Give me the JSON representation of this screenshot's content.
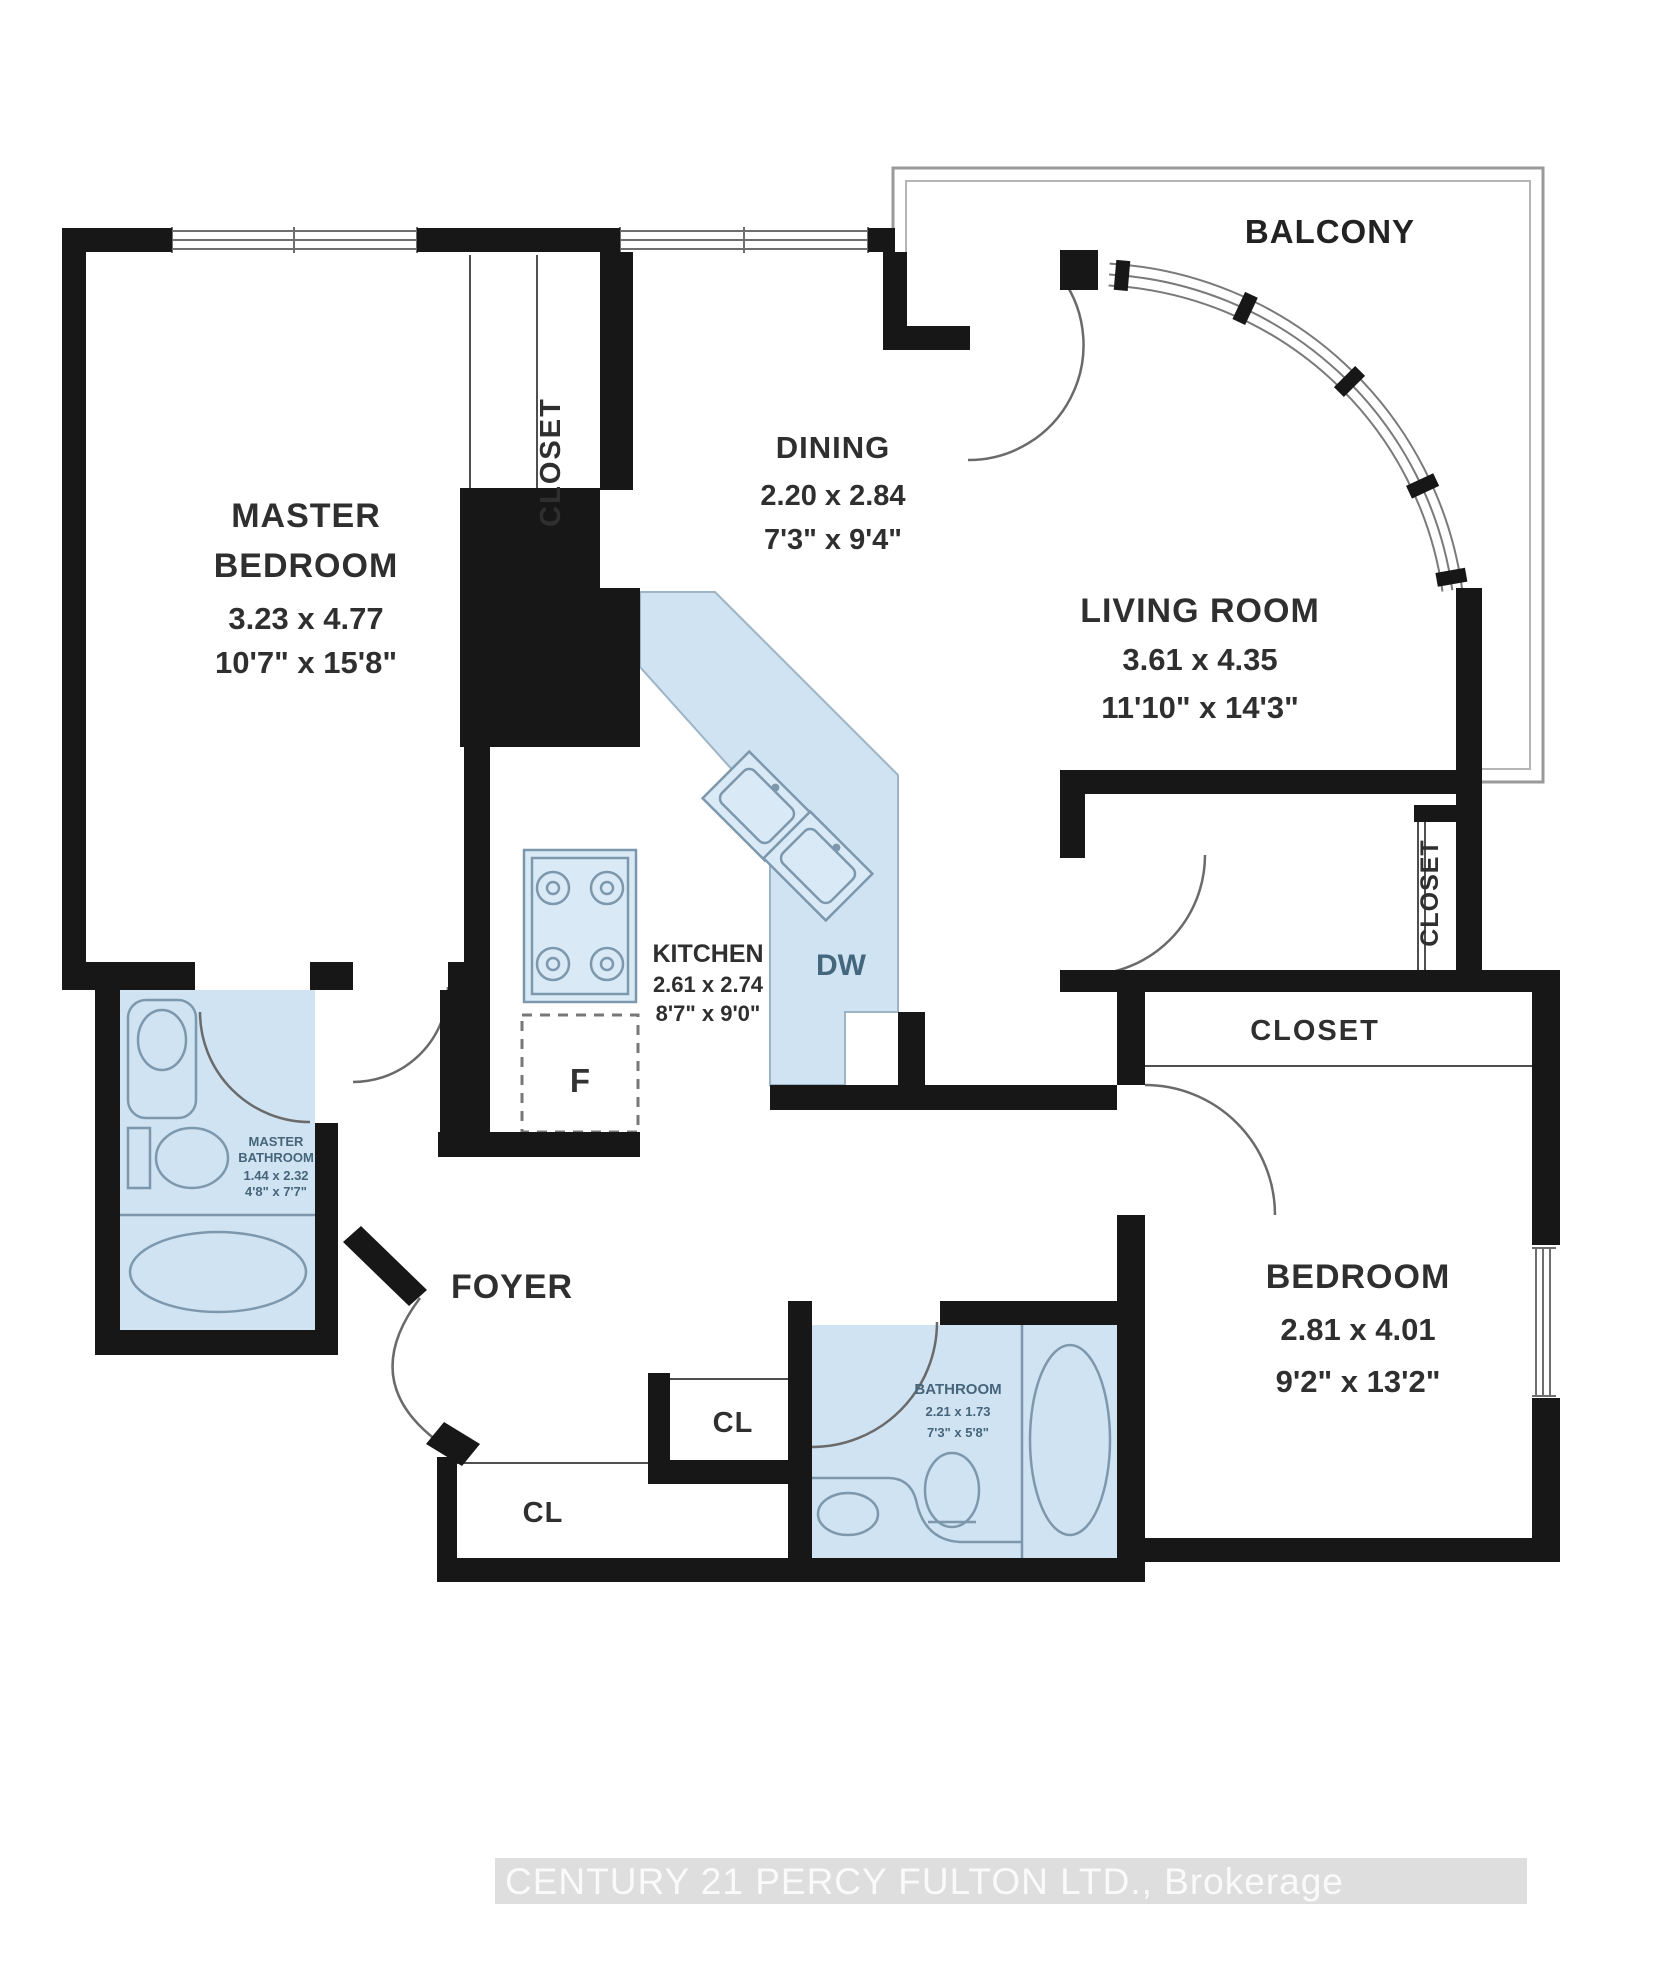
{
  "balcony": {
    "label": "BALCONY"
  },
  "rooms": {
    "master_bedroom": {
      "line1": "MASTER",
      "line2": "BEDROOM",
      "metric": "3.23 x 4.77",
      "imperial": "10'7\" x 15'8\""
    },
    "dining": {
      "label": "DINING",
      "metric": "2.20 x 2.84",
      "imperial": "7'3\" x 9'4\""
    },
    "living_room": {
      "label": "LIVING ROOM",
      "metric": "3.61 x 4.35",
      "imperial": "11'10\" x 14'3\""
    },
    "kitchen": {
      "label": "KITCHEN",
      "metric": "2.61 x 2.74",
      "imperial": "8'7\" x 9'0\""
    },
    "bedroom": {
      "label": "BEDROOM",
      "metric": "2.81 x 4.01",
      "imperial": "9'2\" x 13'2\""
    },
    "master_bathroom": {
      "line1": "MASTER",
      "line2": "BATHROOM",
      "metric": "1.44 x 2.32",
      "imperial": "4'8\" x 7'7\""
    },
    "bathroom": {
      "label": "BATHROOM",
      "metric": "2.21 x 1.73",
      "imperial": "7'3\" x 5'8\""
    },
    "foyer": {
      "label": "FOYER"
    }
  },
  "closets": {
    "master_closet": "CLOSET",
    "hall_closet": "CLOSET",
    "bedroom_closet": "CLOSET",
    "foyer_cl": "CL",
    "hall_cl": "CL"
  },
  "appliances": {
    "dishwasher": "DW",
    "fridge": "F"
  },
  "watermark": {
    "text": "CENTURY 21 PERCY FULTON LTD., Brokerage"
  },
  "colors": {
    "wall": "#171717",
    "wet_area": "#cfe3f2",
    "fixture_line": "#7d98ad",
    "label": "#2f2f2f",
    "small_label": "#46657a",
    "watermark_bg": "#dadada",
    "watermark_text": "#fafafa",
    "balcony_line": "#9a9a9a"
  }
}
